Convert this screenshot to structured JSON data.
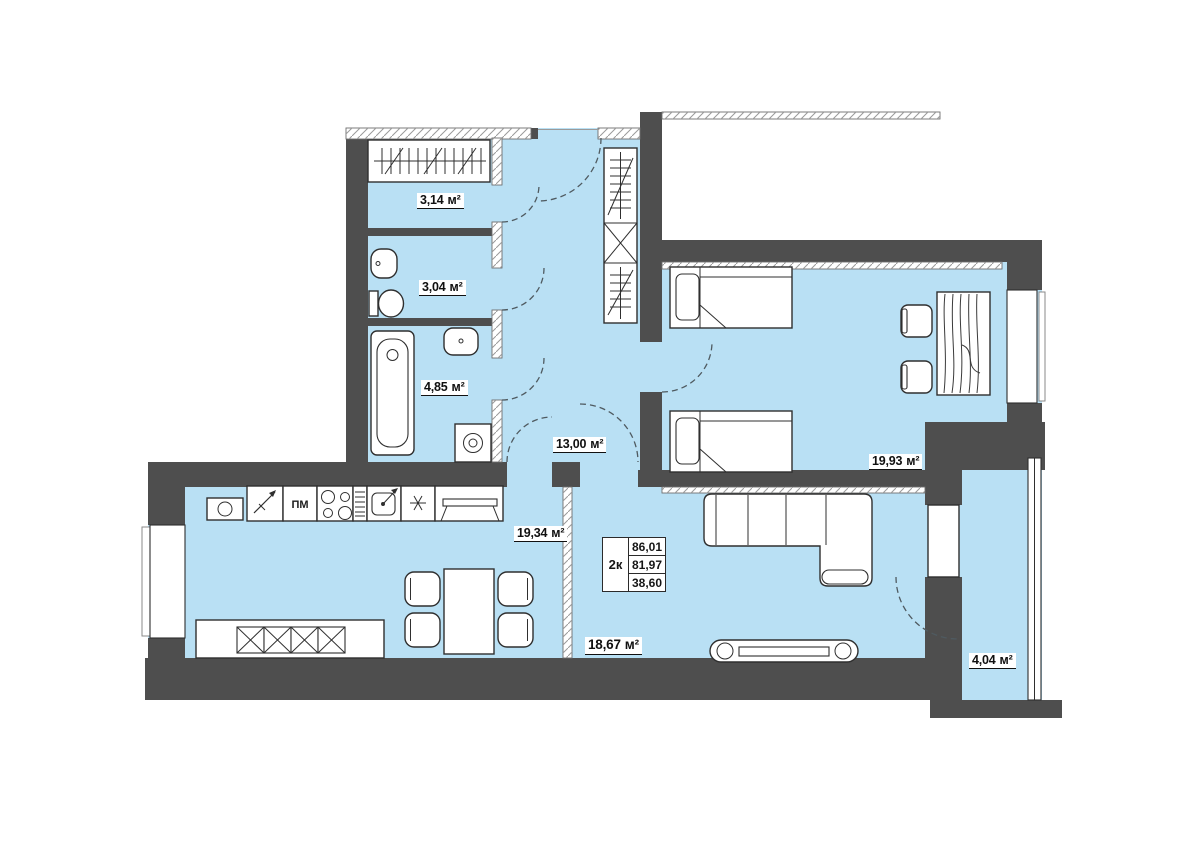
{
  "plan": {
    "summary": {
      "type_label": "2к",
      "values": [
        "86,01",
        "81,97",
        "38,60"
      ]
    },
    "rooms": [
      {
        "id": "wardrobe",
        "area": "3,14",
        "unit": "м²"
      },
      {
        "id": "toilet",
        "area": "3,04",
        "unit": "м²"
      },
      {
        "id": "bathroom",
        "area": "4,85",
        "unit": "м²"
      },
      {
        "id": "hallway",
        "area": "13,00",
        "unit": "м²"
      },
      {
        "id": "kitchen",
        "area": "19,34",
        "unit": "м²"
      },
      {
        "id": "bedroom",
        "area": "19,93",
        "unit": "м²"
      },
      {
        "id": "living-room",
        "area": "18,67",
        "unit": "м²"
      },
      {
        "id": "balcony",
        "area": "4,04",
        "unit": "м²"
      }
    ],
    "kitchen": {
      "appliance_dishwasher_label": "ПМ"
    },
    "colors": {
      "floor": "#b9e0f4",
      "wall": "#4e4e4e",
      "line": "#2f2f2f"
    }
  }
}
